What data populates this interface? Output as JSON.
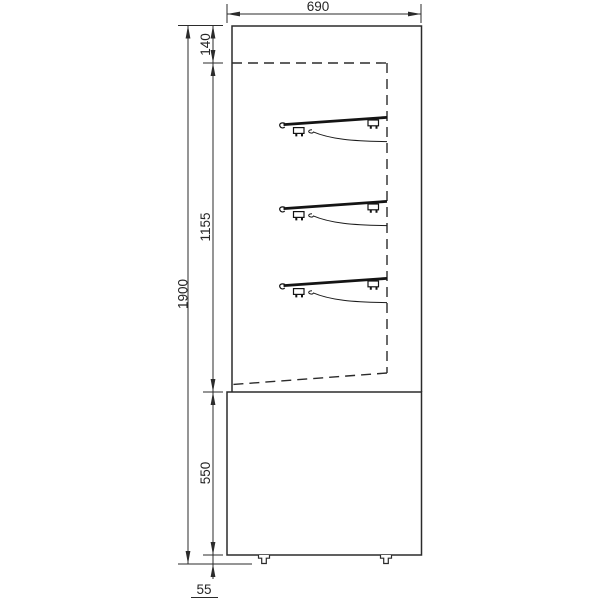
{
  "drawing": {
    "kind": "cabinet-side-elevation",
    "shelf_count": 3,
    "dimensions": {
      "width": "690",
      "top_panel": "140",
      "display_opening": "1155",
      "overall_height": "1900",
      "base_height": "550",
      "feet_height": "55"
    },
    "colors": {
      "line": "#2b2b2b",
      "shelf": "#141414",
      "background": "#ffffff"
    }
  }
}
